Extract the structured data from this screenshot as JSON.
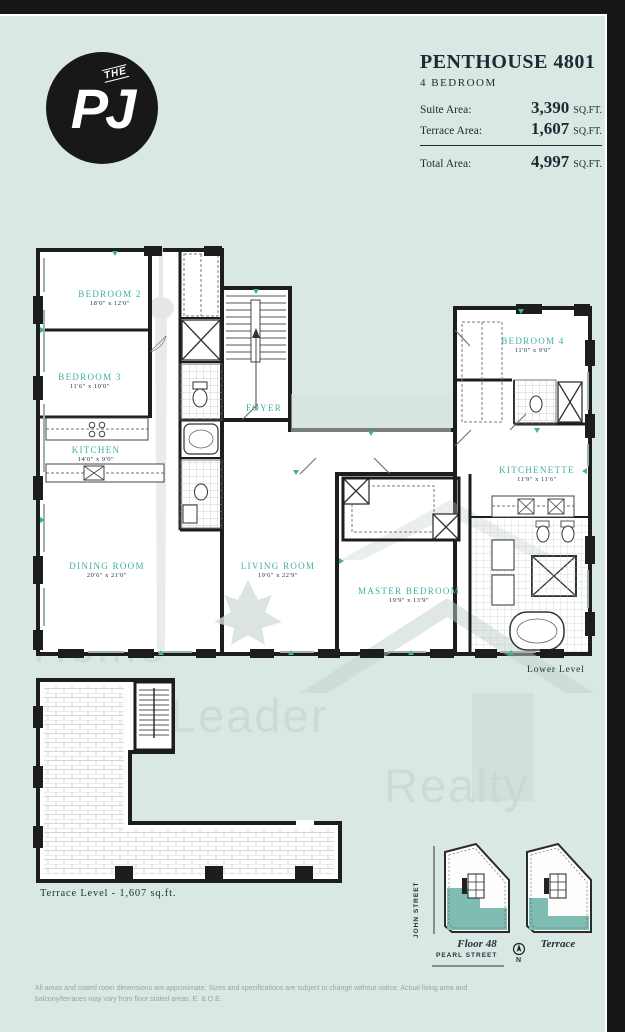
{
  "logo": {
    "prefix": "THE",
    "name": "PJ"
  },
  "header": {
    "title": "PENTHOUSE 4801",
    "subtitle": "4 BEDROOM",
    "rows": [
      {
        "label": "Suite Area:",
        "value": "3,390",
        "unit": "SQ.FT."
      },
      {
        "label": "Terrace Area:",
        "value": "1,607",
        "unit": "SQ.FT."
      }
    ],
    "total": {
      "label": "Total Area:",
      "value": "4,997",
      "unit": "SQ.FT."
    }
  },
  "floorplan": {
    "rooms": [
      {
        "name": "BEDROOM 2",
        "dims": "18'0\" x 12'0\""
      },
      {
        "name": "BEDROOM 3",
        "dims": "11'6\" x 10'0\""
      },
      {
        "name": "KITCHEN",
        "dims": "14'0\" x 9'0\""
      },
      {
        "name": "DINING ROOM",
        "dims": "20'6\" x 21'0\""
      },
      {
        "name": "FOYER",
        "dims": ""
      },
      {
        "name": "LIVING ROOM",
        "dims": "19'6\" x 22'9\""
      },
      {
        "name": "MASTER BEDROOM",
        "dims": "19'9\" x 13'9\""
      },
      {
        "name": "BEDROOM 4",
        "dims": "11'0\" x 9'0\""
      },
      {
        "name": "KITCHENETTE",
        "dims": "11'9\" x 11'6\""
      }
    ],
    "level_label": "Lower Level",
    "terrace_label": "Terrace Level - 1,607 sq.ft."
  },
  "watermark": {
    "line1": "Home",
    "line2": "Leader",
    "line3": "Realty"
  },
  "keyplans": [
    {
      "label": "Floor 48"
    },
    {
      "label": "Terrace"
    }
  ],
  "streets": {
    "vertical": "JOHN STREET",
    "horizontal": "PEARL STREET"
  },
  "compass": {
    "label": "N"
  },
  "disclaimer": "All areas and stated room dimensions are approximate. Sizes and specifications are subject to change without notice. Actual living area and balcony/terraces may vary from floor stated areas. E. & O.E.",
  "colors": {
    "background": "#d9e8e3",
    "wall": "#1d1d1d",
    "accent": "#3fafa5",
    "keyplan_highlight": "#7fbdb2",
    "header_text": "#1c2b33"
  }
}
